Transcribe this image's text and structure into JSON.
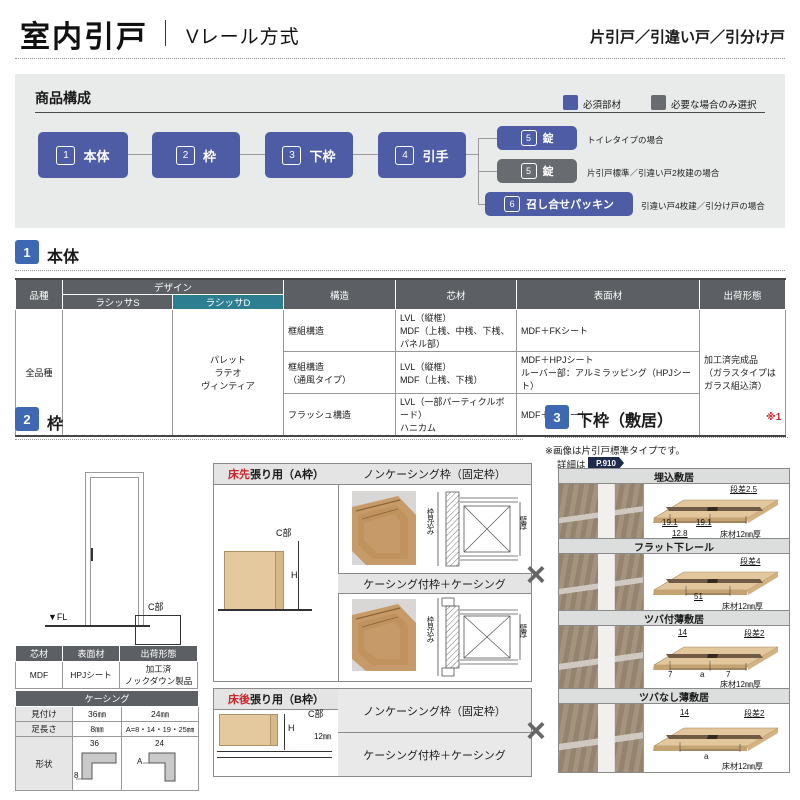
{
  "header": {
    "title": "室内引戸",
    "subtitle": "Vレール方式",
    "door_types": "片引戸／引違い戸／引分け戸"
  },
  "colors": {
    "required_blue": "#4d5ca5",
    "optional_gray": "#686c71",
    "section_blue": "#3e68b2",
    "teal_highlight": "#2d7e91",
    "accent_red": "#c9252b"
  },
  "composition": {
    "title": "商品構成",
    "legend_required": "必須部材",
    "legend_optional": "必要な場合のみ選択",
    "flow": [
      {
        "num": "1",
        "label": "本体"
      },
      {
        "num": "2",
        "label": "枠"
      },
      {
        "num": "3",
        "label": "下枠"
      },
      {
        "num": "4",
        "label": "引手"
      }
    ],
    "branches": [
      {
        "num": "5",
        "label": "錠",
        "note": "トイレタイプの場合"
      },
      {
        "num": "5",
        "label": "錠",
        "note": "片引戸標準／引違い戸2枚建の場合"
      },
      {
        "num": "6",
        "label": "召し合せパッキン",
        "note": "引違い戸4枚建／引分け戸の場合"
      }
    ]
  },
  "body_section": {
    "num": "1",
    "title": "本体",
    "table": {
      "col_hinshu": "品種",
      "col_design": "デザイン",
      "col_lasissa_s": "ラシッサS",
      "col_lasissa_d": "ラシッサD",
      "col_kozo": "構造",
      "col_shinzai": "芯材",
      "col_hyomen": "表面材",
      "col_shukka": "出荷形態",
      "hinshu": "全品種",
      "lasissa_s": "",
      "lasissa_d": "パレット\nラテオ\nヴィンティア",
      "rows": [
        {
          "kozo": "框組構造",
          "shinzai": "LVL（縦框）\nMDF（上桟、中桟、下桟、パネル部）",
          "hyomen": "MDF＋FKシート"
        },
        {
          "kozo": "框組構造\n（通風タイプ）",
          "shinzai": "LVL（縦框）\nMDF（上桟、下桟）",
          "hyomen": "MDF＋HPJシート\nルーバー部：アルミラッピング（HPJシート）"
        },
        {
          "kozo": "フラッシュ構造",
          "shinzai": "LVL（一部パーティクルボード）\nハニカム",
          "hyomen": "MDF＋FKシート"
        }
      ],
      "shukka": "加工済完成品\n（ガラスタイプは\nガラス組込済）"
    }
  },
  "frame_section": {
    "num": "2",
    "title": "枠",
    "door_diagram": {
      "c_label": "C部",
      "fl_label": "▼FL"
    },
    "material_table": {
      "h_shinzai": "芯材",
      "h_hyomen": "表面材",
      "h_shukka": "出荷形態",
      "shinzai": "MDF",
      "hyomen": "HPJシート",
      "shukka": "加工済\nノックダウン製品"
    },
    "casing_table": {
      "title": "ケーシング",
      "row1_label": "見付け",
      "row1_v1": "36㎜",
      "row1_v2": "24㎜",
      "row2_label": "足長さ",
      "row2_v1": "8㎜",
      "row2_v2": "A=8・14・19・25㎜",
      "row3_label": "形状",
      "shape1_top": "36",
      "shape1_side": "8",
      "shape2_top": "24",
      "shape2_side": "A"
    },
    "a_frame": {
      "header_red": "床先",
      "header_rest": "張り用（A枠）",
      "noncasing": "ノンケーシング枠（固定枠）",
      "casing": "ケーシング付枠＋ケーシング",
      "c_label": "C部",
      "h_label": "H",
      "mikomi": "枠見込み",
      "kabeatsu": "壁厚"
    },
    "b_frame": {
      "header_red": "床後",
      "header_rest": "張り用（B枠）",
      "noncasing": "ノンケーシング枠（固定枠）",
      "casing": "ケーシング付枠＋ケーシング",
      "c_label": "C部",
      "h_label": "H",
      "dim": "12㎜"
    }
  },
  "sill_section": {
    "num": "3",
    "title": "下枠（敷居）",
    "ref_mark": "※1",
    "note1": "※画像は片引戸標準タイプです。",
    "note2": "詳細は",
    "badge": "P.910",
    "cross": "×",
    "items": [
      {
        "name": "埋込敷居",
        "labels": {
          "step": "段差2.5",
          "left": "19.1",
          "right": "19.1",
          "bottom": "12.8",
          "floor": "床材12㎜厚"
        }
      },
      {
        "name": "フラット下レール",
        "labels": {
          "step": "段差4",
          "center": "51",
          "floor": "床材12㎜厚"
        }
      },
      {
        "name": "ツバ付薄敷居",
        "labels": {
          "top": "14",
          "step": "段差2",
          "left": "7",
          "center": "a",
          "right": "7",
          "floor": "床材12㎜厚"
        }
      },
      {
        "name": "ツバなし薄敷居",
        "labels": {
          "top": "14",
          "step": "段差2",
          "center": "a",
          "floor": "床材12㎜厚"
        }
      }
    ]
  }
}
